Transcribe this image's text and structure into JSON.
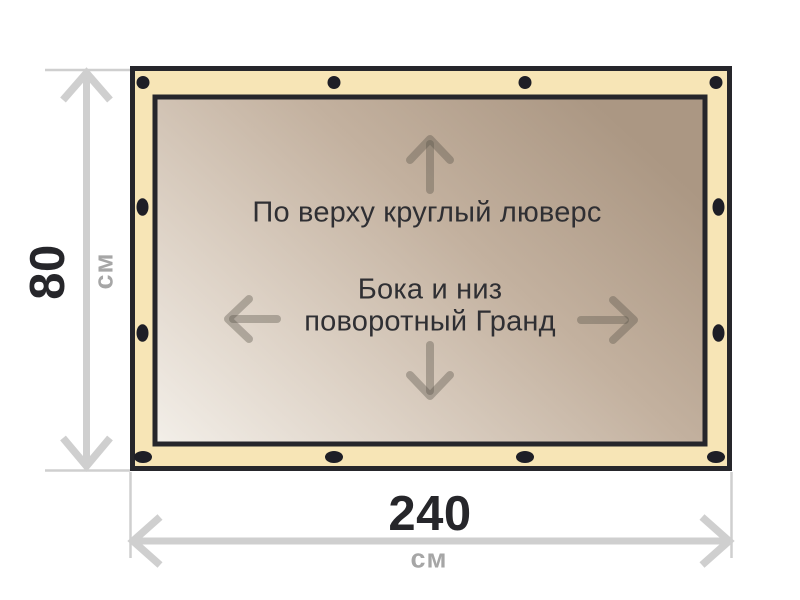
{
  "diagram": {
    "banner": {
      "top_note": "По верху круглый люверс",
      "middle_note_line1": "Бока и низ",
      "middle_note_line2": "поворотный Гранд"
    },
    "dimensions": {
      "height": {
        "value": "80",
        "unit": "см"
      },
      "width": {
        "value": "240",
        "unit": "см"
      }
    },
    "colors": {
      "border_fill": "#f7e5b6",
      "outline": "#26262b",
      "grommet": "#1e1e26",
      "canvas_gradient_start": "#f3efe9",
      "canvas_gradient_end": "#ab9783",
      "dimension_lines": "#cfcfcf",
      "dimension_number_text": "#26262a",
      "dimension_unit_text": "#a6a6a6",
      "note_text": "#2f2f33",
      "direction_arrows": "rgba(90,84,74,0.35)"
    }
  }
}
